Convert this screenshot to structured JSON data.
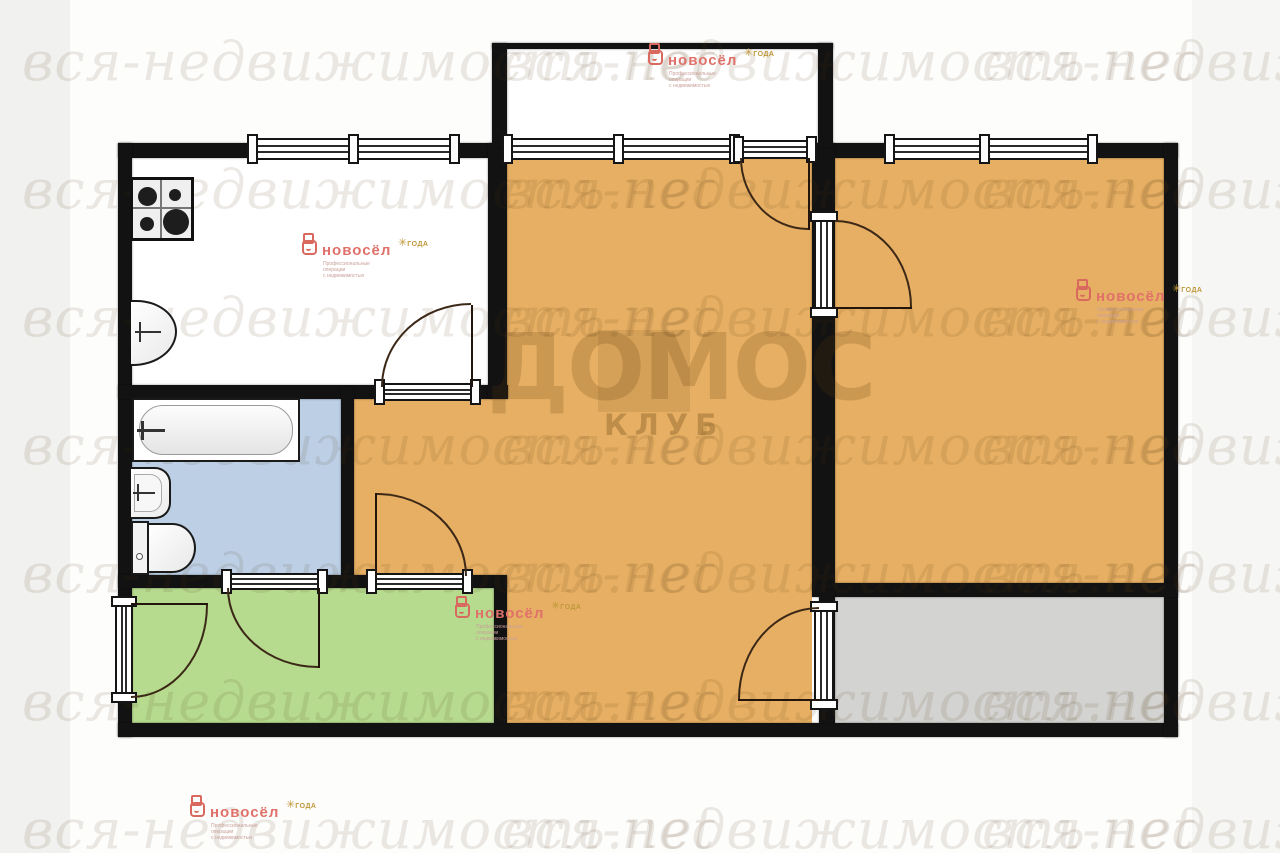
{
  "watermark": {
    "text": "вся-недвижимость.net",
    "rows_y": [
      30,
      158,
      286,
      414,
      542,
      670,
      798
    ],
    "cols_x": [
      22,
      502,
      982
    ],
    "brand": "ДОМОС",
    "brand_sub": "КЛУБ"
  },
  "logo": {
    "name": "новосёл",
    "tagline_line1": "Профессиональные операции",
    "tagline_line2": "с недвижимостью",
    "award_star": "✳",
    "award_text": "ГОДА",
    "positions": [
      {
        "id": "logo-balcony",
        "x": 648,
        "y": 48
      },
      {
        "id": "logo-kitchen",
        "x": 302,
        "y": 238
      },
      {
        "id": "logo-hallway",
        "x": 455,
        "y": 601
      },
      {
        "id": "logo-bedroom",
        "x": 1076,
        "y": 284
      },
      {
        "id": "logo-bottom",
        "x": 190,
        "y": 800
      }
    ]
  },
  "colors": {
    "wall": "#121212",
    "living_orange": "#e7af63",
    "bathroom_blue": "#bccfe5",
    "hallway_green": "#b6da8e",
    "loggia_gray": "#d3d3d1",
    "kitchen_white": "#ffffff",
    "logo_red": "#e0716a",
    "logo_gold": "#c0983c",
    "page_left_strip": "#f1f1ef",
    "page_right_strip": "#f6f6f4"
  },
  "floor_plan": {
    "shades": [
      {
        "name": "page-left-strip",
        "x": 0,
        "y": 0,
        "w": 70,
        "h": 853,
        "color": "#f1f1ef"
      },
      {
        "name": "page-right-strip",
        "x": 1192,
        "y": 0,
        "w": 88,
        "h": 853,
        "color": "#f6f6f4"
      }
    ],
    "rooms": [
      {
        "name": "balcony",
        "x": 497,
        "y": 49,
        "w": 321,
        "h": 94,
        "color": "#ffffff"
      },
      {
        "name": "kitchen",
        "x": 132,
        "y": 158,
        "w": 356,
        "h": 227,
        "color": "#ffffff"
      },
      {
        "name": "bathroom",
        "x": 132,
        "y": 398,
        "w": 209,
        "h": 177,
        "color": "#bccfe5"
      },
      {
        "name": "hallway",
        "x": 132,
        "y": 588,
        "w": 362,
        "h": 135,
        "color": "#b6da8e"
      },
      {
        "name": "corridor",
        "x": 354,
        "y": 398,
        "w": 458,
        "h": 190,
        "color": "#e7af63"
      },
      {
        "name": "living-room",
        "x": 507,
        "y": 158,
        "w": 305,
        "h": 565,
        "color": "#e7af63"
      },
      {
        "name": "bedroom",
        "x": 835,
        "y": 158,
        "w": 329,
        "h": 425,
        "color": "#e7af63"
      },
      {
        "name": "loggia",
        "x": 835,
        "y": 597,
        "w": 329,
        "h": 126,
        "color": "#d3d3d1"
      }
    ],
    "walls": [
      {
        "name": "wall-outer-top",
        "x": 118,
        "y": 143,
        "w": 1060,
        "h": 15
      },
      {
        "name": "wall-outer-left",
        "x": 118,
        "y": 143,
        "w": 14,
        "h": 594
      },
      {
        "name": "wall-outer-bottom",
        "x": 118,
        "y": 723,
        "w": 1060,
        "h": 14
      },
      {
        "name": "wall-outer-right",
        "x": 1164,
        "y": 143,
        "w": 14,
        "h": 594
      },
      {
        "name": "wall-kitchen-bottom",
        "x": 118,
        "y": 385,
        "w": 390,
        "h": 14
      },
      {
        "name": "wall-kitchen-right",
        "x": 488,
        "y": 143,
        "w": 19,
        "h": 255
      },
      {
        "name": "wall-bathroom-right",
        "x": 341,
        "y": 387,
        "w": 13,
        "h": 201
      },
      {
        "name": "wall-hallway-top",
        "x": 118,
        "y": 575,
        "w": 389,
        "h": 13
      },
      {
        "name": "wall-hallway-right",
        "x": 494,
        "y": 577,
        "w": 13,
        "h": 146
      },
      {
        "name": "wall-living-bedroom",
        "x": 812,
        "y": 143,
        "w": 23,
        "h": 447
      },
      {
        "name": "wall-bedroom-bottom",
        "x": 812,
        "y": 583,
        "w": 366,
        "h": 14
      },
      {
        "name": "wall-living-loggia",
        "x": 819,
        "y": 590,
        "w": 16,
        "h": 133
      },
      {
        "name": "balcony-railing",
        "x": 492,
        "y": 43,
        "w": 341,
        "h": 6
      },
      {
        "name": "balcony-stub-left",
        "x": 492,
        "y": 43,
        "w": 15,
        "h": 104
      },
      {
        "name": "balcony-stub-right",
        "x": 818,
        "y": 43,
        "w": 15,
        "h": 104
      }
    ],
    "glazings": [
      {
        "name": "kitchen-window",
        "x": 251,
        "y": 138,
        "w": 206,
        "h": 22,
        "dir": "h",
        "caps": [
          0,
          0.5,
          1
        ]
      },
      {
        "name": "living-room-window",
        "x": 506,
        "y": 138,
        "w": 231,
        "h": 22,
        "dir": "h",
        "caps": [
          0,
          0.49,
          1
        ]
      },
      {
        "name": "bedroom-window",
        "x": 888,
        "y": 138,
        "w": 207,
        "h": 22,
        "dir": "h",
        "caps": [
          0,
          0.47,
          1
        ]
      },
      {
        "name": "balcony-door-sill",
        "x": 737,
        "y": 140,
        "w": 77,
        "h": 19,
        "dir": "h",
        "caps": [
          0,
          1
        ]
      },
      {
        "name": "kitchen-door-sill",
        "x": 378,
        "y": 383,
        "w": 100,
        "h": 18,
        "dir": "h",
        "caps": [
          0,
          1
        ]
      },
      {
        "name": "bathroom-door-sill",
        "x": 225,
        "y": 573,
        "w": 100,
        "h": 17,
        "dir": "h",
        "caps": [
          0,
          1
        ]
      },
      {
        "name": "hallway-door-sill",
        "x": 370,
        "y": 573,
        "w": 100,
        "h": 17,
        "dir": "h",
        "caps": [
          0,
          1
        ]
      },
      {
        "name": "entrance-door-sill",
        "x": 115,
        "y": 600,
        "w": 18,
        "h": 100,
        "dir": "v",
        "caps": [
          0,
          1
        ]
      },
      {
        "name": "bedroom-door-sill",
        "x": 814,
        "y": 215,
        "w": 20,
        "h": 100,
        "dir": "v",
        "caps": [
          0,
          1
        ]
      },
      {
        "name": "loggia-door-sill",
        "x": 814,
        "y": 605,
        "w": 20,
        "h": 102,
        "dir": "v",
        "caps": [
          0,
          1
        ]
      }
    ],
    "doors": [
      {
        "name": "kitchen-door",
        "leaf": {
          "x": 471,
          "y": 305,
          "w": 2,
          "h": 82
        },
        "arc": {
          "x": 381,
          "y": 303,
          "w": 90,
          "h": 84,
          "corner": "tl"
        }
      },
      {
        "name": "balcony-door",
        "leaf": {
          "x": 808,
          "y": 158,
          "w": 2,
          "h": 72
        },
        "arc": {
          "x": 740,
          "y": 158,
          "w": 68,
          "h": 72,
          "corner": "bl"
        }
      },
      {
        "name": "bedroom-door",
        "leaf": {
          "x": 835,
          "y": 307,
          "w": 77,
          "h": 2
        },
        "arc": {
          "x": 835,
          "y": 220,
          "w": 77,
          "h": 87,
          "corner": "tr"
        }
      },
      {
        "name": "hallway-corridor-door",
        "leaf": {
          "x": 375,
          "y": 493,
          "w": 2,
          "h": 82
        },
        "arc": {
          "x": 377,
          "y": 493,
          "w": 90,
          "h": 83,
          "corner": "tr"
        }
      },
      {
        "name": "bathroom-door",
        "leaf": {
          "x": 318,
          "y": 588,
          "w": 2,
          "h": 80
        },
        "arc": {
          "x": 227,
          "y": 588,
          "w": 91,
          "h": 80,
          "corner": "bl"
        }
      },
      {
        "name": "entrance-door",
        "leaf": {
          "x": 131,
          "y": 603,
          "w": 77,
          "h": 2
        },
        "arc": {
          "x": 131,
          "y": 605,
          "w": 77,
          "h": 93,
          "corner": "br"
        }
      },
      {
        "name": "loggia-door",
        "leaf": {
          "x": 738,
          "y": 699,
          "w": 82,
          "h": 2
        },
        "arc": {
          "x": 738,
          "y": 607,
          "w": 81,
          "h": 92,
          "corner": "tl"
        }
      }
    ],
    "fixtures": [
      {
        "type": "stove",
        "name": "gas-stove-icon",
        "x": 130,
        "y": 177,
        "w": 64,
        "h": 64
      },
      {
        "type": "ksink",
        "name": "kitchen-sink-icon",
        "x": 131,
        "y": 300,
        "w": 46,
        "h": 66
      },
      {
        "type": "tub",
        "name": "bathtub-icon",
        "x": 132,
        "y": 398,
        "w": 168,
        "h": 64
      },
      {
        "type": "bsink",
        "name": "washbasin-icon",
        "x": 131,
        "y": 467,
        "w": 40,
        "h": 52
      },
      {
        "type": "toilet",
        "name": "toilet-icon",
        "x": 131,
        "y": 521,
        "w": 65,
        "h": 54
      }
    ],
    "domos": {
      "x": 487,
      "y": 322,
      "font": 92,
      "square": {
        "x": 598,
        "y": 330,
        "w": 92,
        "h": 82
      },
      "sub": {
        "x": 604,
        "y": 408,
        "font": 29
      }
    }
  }
}
